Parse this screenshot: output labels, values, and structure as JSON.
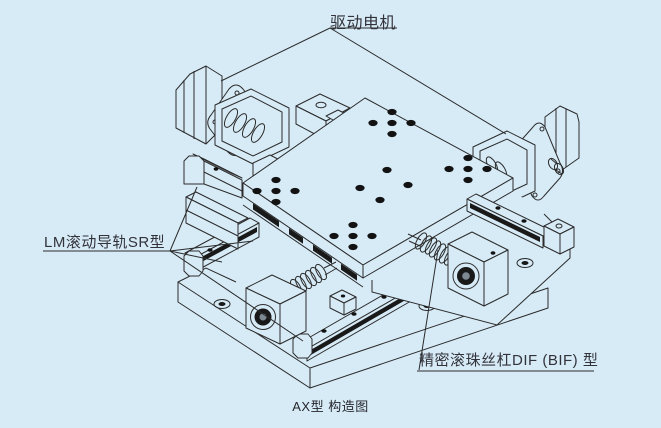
{
  "page": {
    "background_color": "#d7ebf7",
    "line_color": "#2b2b2b",
    "text_color": "#32323a"
  },
  "labels": {
    "drive_motor": "驱动电机",
    "lm_guide": "LM滚动导轨SR型",
    "ball_screw": "精密滚珠丝杠DIF (BIF) 型",
    "caption": "AX型  构造图"
  }
}
